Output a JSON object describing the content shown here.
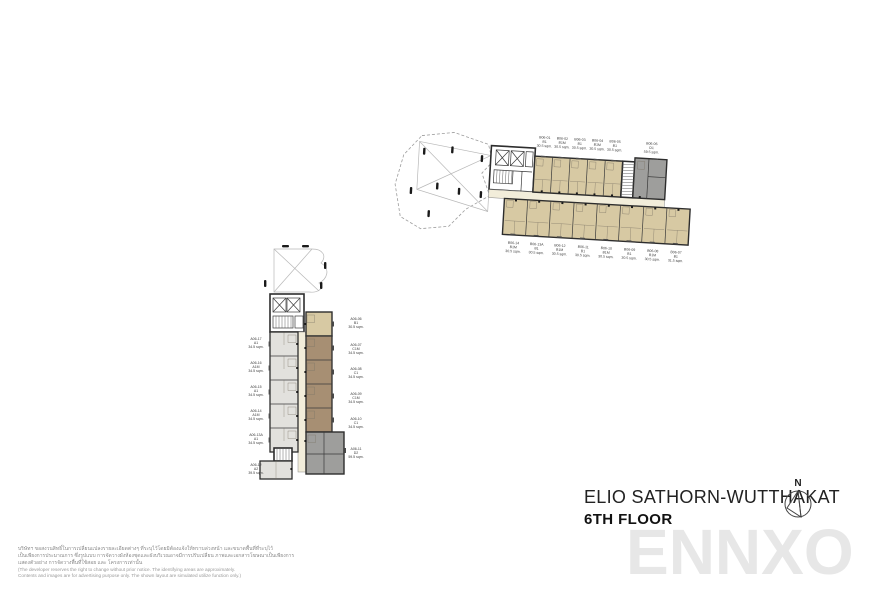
{
  "title": {
    "project": "ELIO SATHORN-WUTTHAKAT",
    "floor": "6TH FLOOR"
  },
  "compass": {
    "label": "N"
  },
  "watermark": {
    "text": "ENNXO"
  },
  "disclaimer": {
    "thai_lines": [
      "บริษัทฯ ขอสงวนสิทธิ์ในการเปลี่ยนแปลงรายละเอียดต่างๆ ที่ระบุไว้โดยมิต้องแจ้งให้ทราบล่วงหน้า และขนาดพื้นที่ที่ระบุไว้",
      "เป็นเพียงการประมาณการ ซึ่งรูปแบบ การจัดวางผังห้องชุดและผังบริเวณอาจมีการปรับเปลี่ยน ภาพและเอกสารโฆษณาเป็นเพียงการ",
      "แสดงตัวอย่าง การจัดวางพื้นที่ใช้สอย และ โครงการเท่านั้น"
    ],
    "english_lines": [
      "(The developer reserves the right to change without prior notice. The identifying areas are approximately.",
      "Contents and images are for advertising purpose only. The shown layout are simulated utilize function only.)"
    ]
  },
  "legend_colors": {
    "unit_beige": "#d7c9a3",
    "unit_brown": "#a78f73",
    "unit_gray": "#9e9e9c",
    "unit_light_gray": "#e2e1dd",
    "corridor_cream": "#f2edda"
  },
  "plan_b": {
    "name": "Building B wing",
    "top_units": [
      {
        "id": "B06-01",
        "type": "B1",
        "area": "30.5 sqm."
      },
      {
        "id": "B06-02",
        "type": "B1M",
        "area": "30.5 sqm."
      },
      {
        "id": "B06-03",
        "type": "B1",
        "area": "30.5 sqm."
      },
      {
        "id": "B06-04",
        "type": "B1M",
        "area": "30.5 sqm."
      },
      {
        "id": "B06-05",
        "type": "B1",
        "area": "30.5 sqm."
      },
      {
        "id": "B06-06",
        "type": "D1",
        "area": "59.5 sqm."
      }
    ],
    "bottom_units": [
      {
        "id": "B06-14",
        "type": "B1M",
        "area": "30.5 sqm."
      },
      {
        "id": "B06-13A",
        "type": "B1",
        "area": "30.5 sqm."
      },
      {
        "id": "B06-12",
        "type": "B1M",
        "area": "30.5 sqm."
      },
      {
        "id": "B06-11",
        "type": "B1",
        "area": "30.5 sqm."
      },
      {
        "id": "B06-10",
        "type": "B1M",
        "area": "30.5 sqm."
      },
      {
        "id": "B06-09",
        "type": "B1",
        "area": "30.5 sqm."
      },
      {
        "id": "B06-08",
        "type": "B1M",
        "area": "30.5 sqm."
      },
      {
        "id": "B06-07",
        "type": "B1",
        "area": "31.5 sqm."
      }
    ]
  },
  "plan_a": {
    "name": "Building A tower",
    "left_units": [
      {
        "id": "A06-17",
        "type": "A1",
        "area": "34.5 sqm."
      },
      {
        "id": "A06-16",
        "type": "A1M",
        "area": "34.5 sqm."
      },
      {
        "id": "A06-15",
        "type": "A1",
        "area": "34.5 sqm."
      },
      {
        "id": "A06-14",
        "type": "A1M",
        "area": "34.5 sqm."
      },
      {
        "id": "A06-13A",
        "type": "A1",
        "area": "34.5 sqm."
      },
      {
        "id": "A06-12",
        "type": "A2",
        "area": "39.5 sqm."
      }
    ],
    "right_units": [
      {
        "id": "A06-06",
        "type": "B1",
        "area": "30.5 sqm."
      },
      {
        "id": "A06-07",
        "type": "C1M",
        "area": "34.5 sqm."
      },
      {
        "id": "A06-08",
        "type": "C1",
        "area": "34.5 sqm."
      },
      {
        "id": "A06-09",
        "type": "C1M",
        "area": "34.5 sqm."
      },
      {
        "id": "A06-10",
        "type": "C1",
        "area": "34.5 sqm."
      },
      {
        "id": "A06-11",
        "type": "D2",
        "area": "59.5 sqm."
      }
    ]
  }
}
